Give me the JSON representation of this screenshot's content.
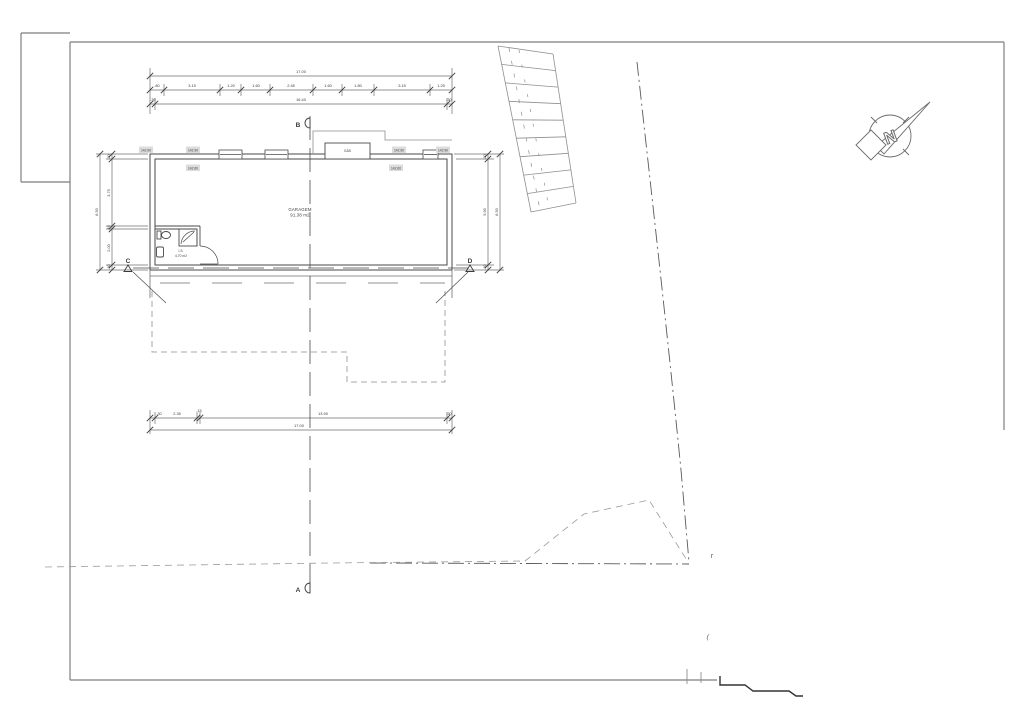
{
  "drawing": {
    "plan_labels": {
      "garage_name": "GARAGEM",
      "garage_area": "91,38 m2",
      "wc_name": "I.S.",
      "wc_area": "4,70 m2",
      "gas": "GÁS"
    },
    "levels": {
      "top": [
        "142.90",
        "142.90",
        "142.90",
        "142.90"
      ],
      "inner": [
        "142.60",
        "142.60"
      ]
    },
    "dims": {
      "top_total": "17.00",
      "top_segments": [
        ".80",
        "3.15",
        "1.20",
        "1.60",
        "2.45",
        "1.60",
        "1.80",
        "3.15",
        "1.25"
      ],
      "top_inner": [
        ".30",
        "16.40",
        ".30"
      ],
      "bottom_segments": [
        ".30",
        "2.35",
        ".15",
        "13.90",
        ".30"
      ],
      "bottom_total": "17.00",
      "left_segments": [
        ".30",
        "3.75",
        ".15",
        "2.00",
        ".30"
      ],
      "left_total": "6.50",
      "right_segments": [
        ".30",
        "5.90",
        ".30"
      ],
      "right_total": "6.50"
    },
    "section_markers": {
      "a": "A",
      "b": "B",
      "c": "C",
      "d": "D"
    },
    "north": "N",
    "stray": {
      "r": "r",
      "paren": "("
    }
  },
  "colors": {
    "line": "#4a4a4a",
    "light": "#8f8f8f",
    "frame": "#7e7e7e",
    "label_bg": "#dcdcdc"
  }
}
